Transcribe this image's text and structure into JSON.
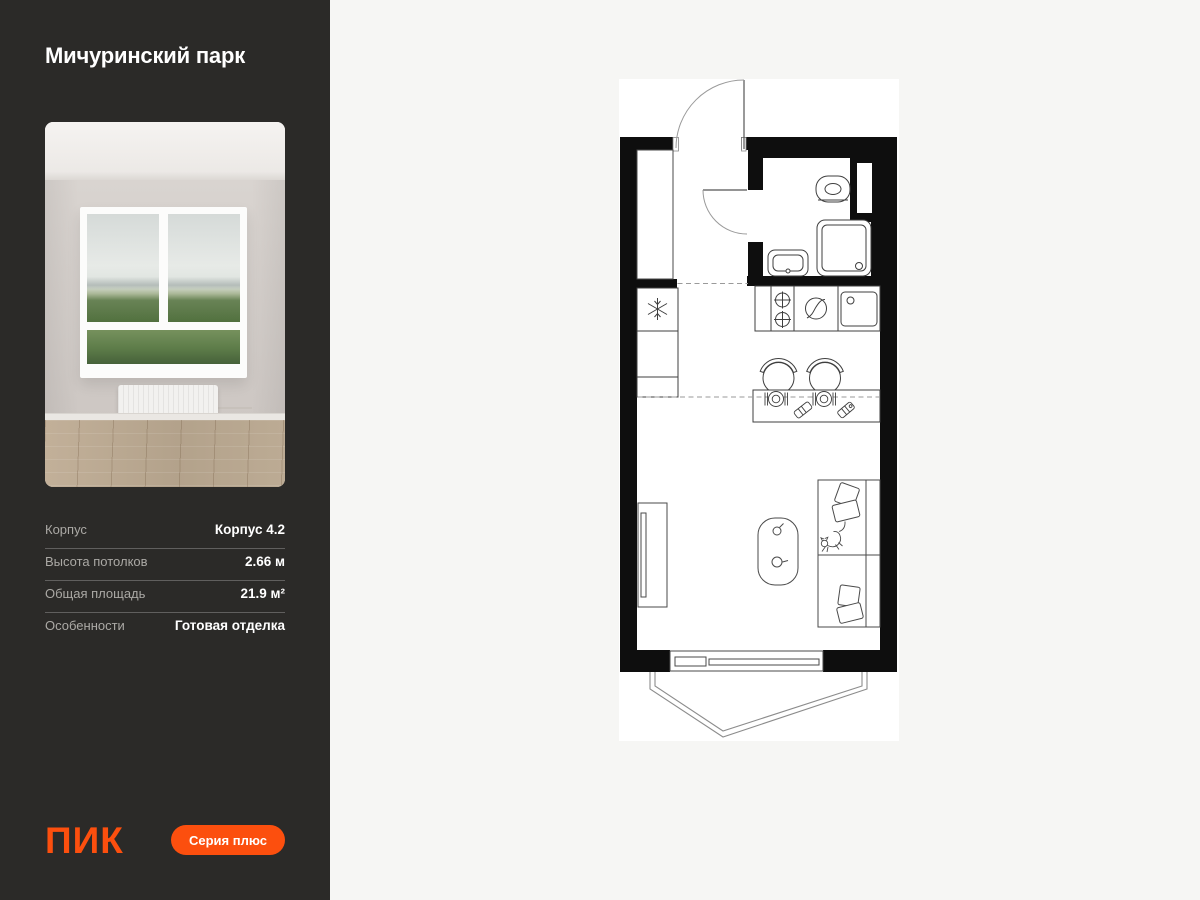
{
  "colors": {
    "accent_orange": "#fc4f0e",
    "sidebar_bg": "#2b2a28",
    "canvas_bg": "#f6f6f4",
    "plan_wall": "#0e0e0e",
    "plan_bg": "#ffffff"
  },
  "sidebar": {
    "title": "Мичуринский парк",
    "details": {
      "rows": [
        {
          "label": "Корпус",
          "value": "Корпус 4.2"
        },
        {
          "label": "Высота потолков",
          "value": "2.66 м"
        },
        {
          "label": "Общая площадь",
          "value": "21.9 м²"
        },
        {
          "label": "Особенности",
          "value": "Готовая отделка"
        }
      ]
    },
    "footer": {
      "logo": "ПИК",
      "badge": "Серия плюс"
    }
  }
}
